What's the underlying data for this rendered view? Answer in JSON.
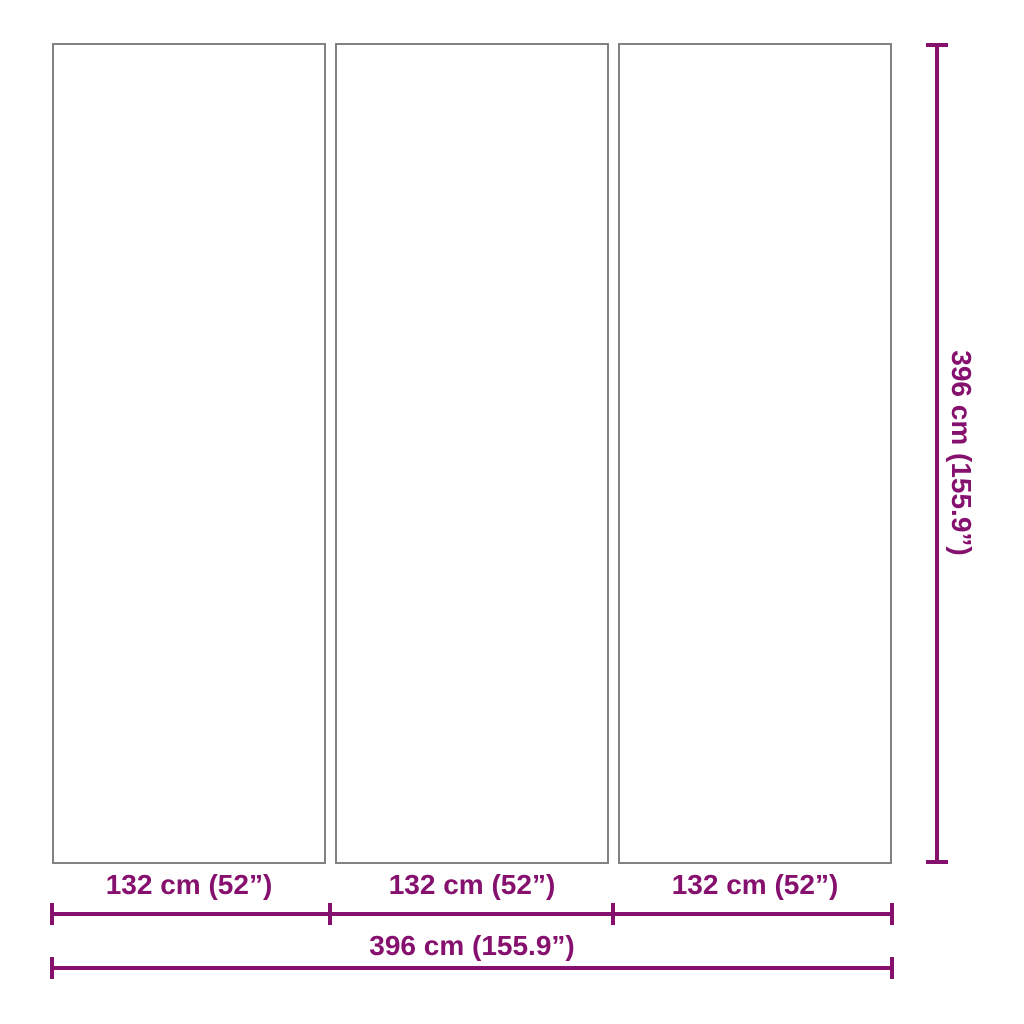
{
  "diagram": {
    "accent_color": "#86106E",
    "panel_border_color": "#828282",
    "panels": [
      {
        "width_label": "132 cm (52”)"
      },
      {
        "width_label": "132 cm (52”)"
      },
      {
        "width_label": "132 cm (52”)"
      }
    ],
    "total_width_label": "396 cm (155.9”)",
    "height_label": "396 cm (155.9”)"
  }
}
